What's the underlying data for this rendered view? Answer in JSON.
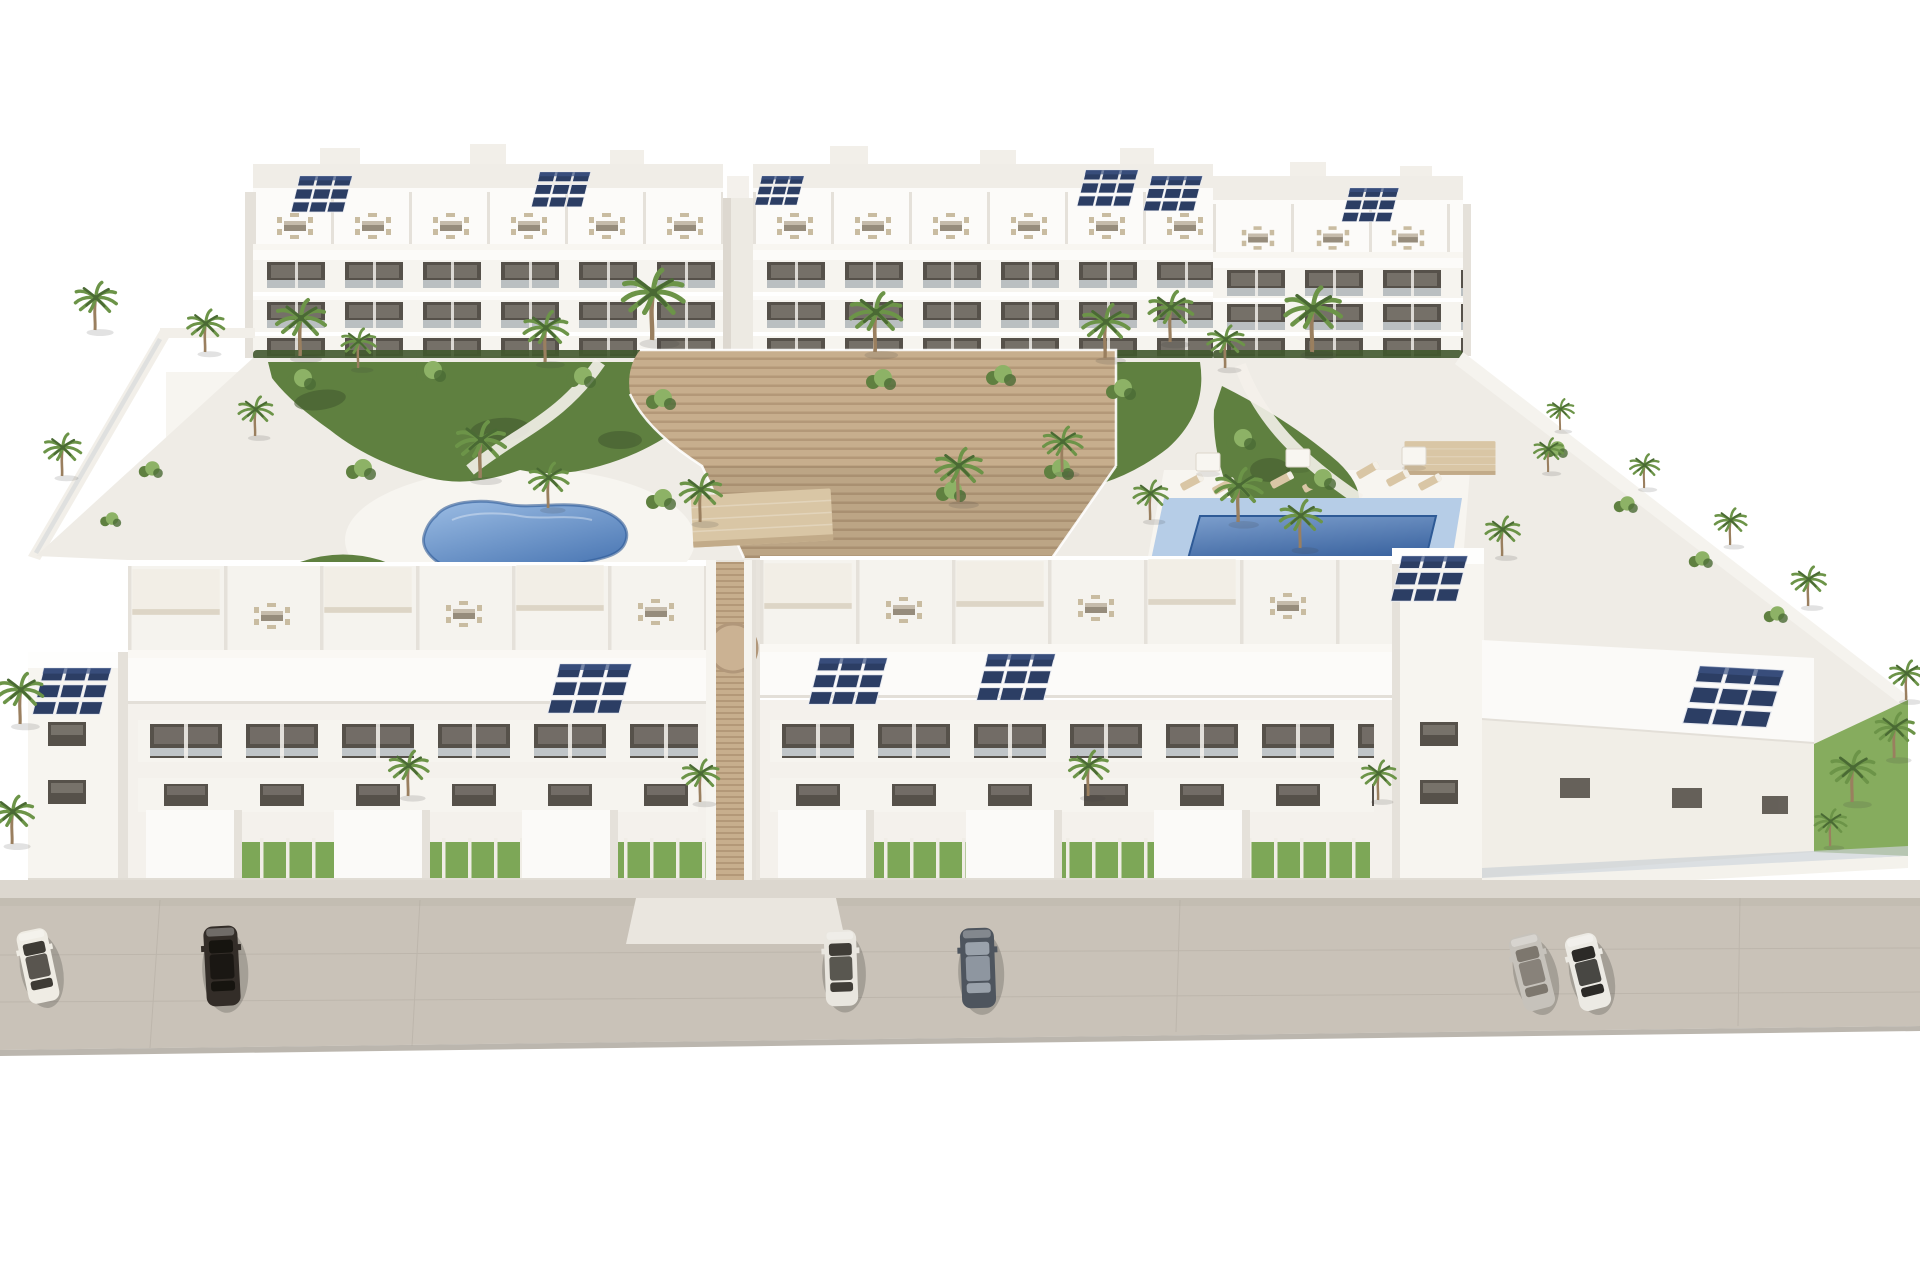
{
  "meta": {
    "description": "Aerial 3D architectural rendering of a modern white residential apartment complex with two rows of three-storey buildings, roof terraces with outdoor furniture and pergolas, rooftop solar panels, a landscaped central courtyard with palm trees, a freeform kidney-shaped pool, a rectangular pool with sun loungers, a central wooden stair deck, perimeter walls, and a street in front with six parked cars."
  },
  "palette": {
    "sky": "#ffffff",
    "paving": "#efece6",
    "pavingBright": "#f7f5f0",
    "street": "#c9c2b8",
    "streetTop": "#beb7ac",
    "streetEdge": "#a8a197",
    "sidewalk": "#dcd7cf",
    "apron": "#eae6df",
    "wallWhite": "#f6f4ef",
    "wallBright": "#fcfbf9",
    "wallShade": "#e5e1da",
    "wallShadow": "#d7d2ca",
    "windowDark": "#56514a",
    "windowGlass": "#8e8881",
    "railGlass": "#ccd2d6",
    "grass": "#7da757",
    "lawn": "#86ac5e",
    "gardenGreen": "#5f8040",
    "gardenDark": "#41582e",
    "bushLight": "#8db266",
    "palmGreen": "#6c9448",
    "palmDark": "#4a6a34",
    "trunk": "#9a7f5f",
    "solarBlue": "#2c3e64",
    "solarLight": "#3d5484",
    "wood": "#c7ae8d",
    "woodDark": "#b39878",
    "poolDeck": "#b6cde7",
    "poolRim": "#2e5a96",
    "canopyTan": "#d9c6a5",
    "canopyEdge": "#c2ab89",
    "furnTable": "#968c7c",
    "furnChair": "#c9bca1"
  },
  "scene": {
    "buildings": {
      "rear_block": "long three-storey apartment building with roof terraces, terrace furniture and solar panels",
      "front_left_block": "three-storey apartment building with courtyard roof terraces, street facade, garages and front yards",
      "front_right_block": "three-storey apartment building with courtyard roof terraces, street facade, garages, right wing and corner tower",
      "central_feature": "wide timber stair deck descending from the rear block to a passage between the front blocks"
    },
    "pools": [
      {
        "name": "freeform-pool",
        "shape": "kidney",
        "colors": [
          "#9cbde4",
          "#4d79b5"
        ]
      },
      {
        "name": "rectangular-pool",
        "shape": "rectangle",
        "colors": [
          "#7d9fcd",
          "#3a639f"
        ]
      }
    ],
    "street": {
      "cars": [
        {
          "x": 38,
          "y": 966,
          "r": -12,
          "s": 0.92,
          "c1": "#efece4",
          "c2": "#3e3b35"
        },
        {
          "x": 222,
          "y": 966,
          "r": -3,
          "s": 1.0,
          "c1": "#332d28",
          "c2": "#16140f"
        },
        {
          "x": 841,
          "y": 968,
          "r": -2,
          "s": 0.95,
          "c1": "#e9e6df",
          "c2": "#403d37"
        },
        {
          "x": 978,
          "y": 968,
          "r": -2,
          "s": 1.0,
          "c1": "#4e555e",
          "c2": "#9aa2ab"
        },
        {
          "x": 1532,
          "y": 972,
          "r": -14,
          "s": 0.95,
          "c1": "#c6c2bb",
          "c2": "#7d776e"
        },
        {
          "x": 1588,
          "y": 972,
          "r": -14,
          "s": 0.95,
          "c1": "#eceae4",
          "c2": "#2c2a27"
        }
      ]
    },
    "equipment": {
      "solar_rear": [
        {
          "x": 300,
          "y": 176,
          "s": 0.62
        },
        {
          "x": 540,
          "y": 172,
          "s": 0.6
        },
        {
          "x": 762,
          "y": 176,
          "s": 0.5
        },
        {
          "x": 1086,
          "y": 170,
          "s": 0.62
        },
        {
          "x": 1152,
          "y": 176,
          "s": 0.6
        },
        {
          "x": 1350,
          "y": 188,
          "s": 0.58
        }
      ],
      "solar_front": [
        {
          "x": 44,
          "y": 668,
          "s": 0.8
        },
        {
          "x": 560,
          "y": 664,
          "s": 0.85
        },
        {
          "x": 820,
          "y": 658,
          "s": 0.8
        },
        {
          "x": 988,
          "y": 654,
          "s": 0.8
        },
        {
          "x": 1402,
          "y": 556,
          "s": 0.78
        },
        {
          "x": 1700,
          "y": 666,
          "s": 1.0,
          "r": 3
        }
      ],
      "furniture_rear": [
        {
          "x": 295,
          "y": 226
        },
        {
          "x": 373,
          "y": 226
        },
        {
          "x": 451,
          "y": 226
        },
        {
          "x": 529,
          "y": 226
        },
        {
          "x": 607,
          "y": 226
        },
        {
          "x": 685,
          "y": 226
        },
        {
          "x": 795,
          "y": 226
        },
        {
          "x": 873,
          "y": 226
        },
        {
          "x": 951,
          "y": 226
        },
        {
          "x": 1029,
          "y": 226
        },
        {
          "x": 1107,
          "y": 226
        },
        {
          "x": 1185,
          "y": 226
        },
        {
          "x": 1258,
          "y": 238,
          "s": 0.9
        },
        {
          "x": 1333,
          "y": 238,
          "s": 0.9
        },
        {
          "x": 1408,
          "y": 238,
          "s": 0.9
        }
      ],
      "furniture_front": [
        {
          "x": 272,
          "y": 616
        },
        {
          "x": 464,
          "y": 614
        },
        {
          "x": 656,
          "y": 612
        },
        {
          "x": 904,
          "y": 610
        },
        {
          "x": 1096,
          "y": 608
        },
        {
          "x": 1288,
          "y": 606
        }
      ],
      "pergolas_white": [
        {
          "x": 176,
          "y": 592,
          "s": 0.95
        },
        {
          "x": 368,
          "y": 590,
          "s": 0.95
        },
        {
          "x": 560,
          "y": 588,
          "s": 0.95
        },
        {
          "x": 808,
          "y": 586,
          "s": 0.95
        },
        {
          "x": 1000,
          "y": 584,
          "s": 0.95
        },
        {
          "x": 1192,
          "y": 582,
          "s": 0.95
        }
      ],
      "pergolas_tan": [
        {
          "x": 762,
          "y": 518,
          "s": 1.0,
          "r": -3
        },
        {
          "x": 1450,
          "y": 458,
          "s": 0.65
        }
      ],
      "loungers": [
        {
          "x": 1192,
          "y": 482,
          "r": -28
        },
        {
          "x": 1224,
          "y": 486,
          "r": -28
        },
        {
          "x": 1282,
          "y": 480,
          "r": -28
        },
        {
          "x": 1314,
          "y": 484,
          "r": -28
        },
        {
          "x": 1398,
          "y": 478,
          "r": -28
        },
        {
          "x": 1430,
          "y": 482,
          "r": -28
        },
        {
          "x": 1368,
          "y": 470,
          "r": -30
        },
        {
          "x": 352,
          "y": 590,
          "r": 20
        },
        {
          "x": 384,
          "y": 594,
          "r": 20
        },
        {
          "x": 414,
          "y": 598,
          "r": 20
        }
      ],
      "parasols": [
        {
          "x": 1208,
          "y": 462
        },
        {
          "x": 1298,
          "y": 458
        },
        {
          "x": 1414,
          "y": 456
        }
      ]
    },
    "vegetation": {
      "palms_back": [
        {
          "x": 300,
          "y": 356,
          "s": 1.0
        },
        {
          "x": 358,
          "y": 368,
          "s": 0.7
        },
        {
          "x": 545,
          "y": 362,
          "s": 0.9
        },
        {
          "x": 652,
          "y": 340,
          "s": 1.25
        },
        {
          "x": 875,
          "y": 352,
          "s": 1.05
        },
        {
          "x": 1105,
          "y": 358,
          "s": 0.95
        },
        {
          "x": 1170,
          "y": 342,
          "s": 0.9
        },
        {
          "x": 1225,
          "y": 368,
          "s": 0.75
        },
        {
          "x": 1312,
          "y": 352,
          "s": 1.15
        },
        {
          "x": 95,
          "y": 330,
          "s": 0.85
        },
        {
          "x": 205,
          "y": 352,
          "s": 0.75
        },
        {
          "x": 255,
          "y": 436,
          "s": 0.7
        },
        {
          "x": 62,
          "y": 476,
          "s": 0.75
        },
        {
          "x": 480,
          "y": 478,
          "s": 1.0
        },
        {
          "x": 548,
          "y": 508,
          "s": 0.8
        },
        {
          "x": 700,
          "y": 522,
          "s": 0.85
        },
        {
          "x": 958,
          "y": 502,
          "s": 0.95
        },
        {
          "x": 1062,
          "y": 472,
          "s": 0.8
        },
        {
          "x": 1150,
          "y": 520,
          "s": 0.7
        },
        {
          "x": 1238,
          "y": 522,
          "s": 0.95
        },
        {
          "x": 1300,
          "y": 548,
          "s": 0.85
        },
        {
          "x": 1502,
          "y": 556,
          "s": 0.7
        },
        {
          "x": 1548,
          "y": 472,
          "s": 0.6
        },
        {
          "x": 1560,
          "y": 430,
          "s": 0.55
        },
        {
          "x": 1644,
          "y": 488,
          "s": 0.6
        },
        {
          "x": 1730,
          "y": 545,
          "s": 0.65
        },
        {
          "x": 1808,
          "y": 606,
          "s": 0.7
        }
      ],
      "palms_front": [
        {
          "x": 20,
          "y": 724,
          "s": 0.9
        },
        {
          "x": 12,
          "y": 844,
          "s": 0.85
        },
        {
          "x": 408,
          "y": 796,
          "s": 0.8
        },
        {
          "x": 700,
          "y": 802,
          "s": 0.75
        },
        {
          "x": 1088,
          "y": 796,
          "s": 0.8
        },
        {
          "x": 1378,
          "y": 800,
          "s": 0.7
        },
        {
          "x": 1852,
          "y": 802,
          "s": 0.9
        },
        {
          "x": 1894,
          "y": 758,
          "s": 0.8
        },
        {
          "x": 1830,
          "y": 846,
          "s": 0.65
        },
        {
          "x": 1906,
          "y": 700,
          "s": 0.7
        }
      ],
      "bushes": [
        {
          "x": 300,
          "y": 380
        },
        {
          "x": 430,
          "y": 372
        },
        {
          "x": 580,
          "y": 378
        },
        {
          "x": 660,
          "y": 400
        },
        {
          "x": 880,
          "y": 380
        },
        {
          "x": 1000,
          "y": 376
        },
        {
          "x": 1120,
          "y": 390
        },
        {
          "x": 1240,
          "y": 440
        },
        {
          "x": 1320,
          "y": 480
        },
        {
          "x": 360,
          "y": 470
        },
        {
          "x": 300,
          "y": 580,
          "s": 0.8
        },
        {
          "x": 660,
          "y": 500
        },
        {
          "x": 950,
          "y": 492
        },
        {
          "x": 1058,
          "y": 470
        },
        {
          "x": 150,
          "y": 470,
          "s": 0.8
        },
        {
          "x": 110,
          "y": 520,
          "s": 0.7
        },
        {
          "x": 1555,
          "y": 450,
          "s": 0.8
        },
        {
          "x": 1625,
          "y": 505,
          "s": 0.8
        },
        {
          "x": 1700,
          "y": 560,
          "s": 0.8
        },
        {
          "x": 1775,
          "y": 615,
          "s": 0.8
        }
      ]
    }
  }
}
